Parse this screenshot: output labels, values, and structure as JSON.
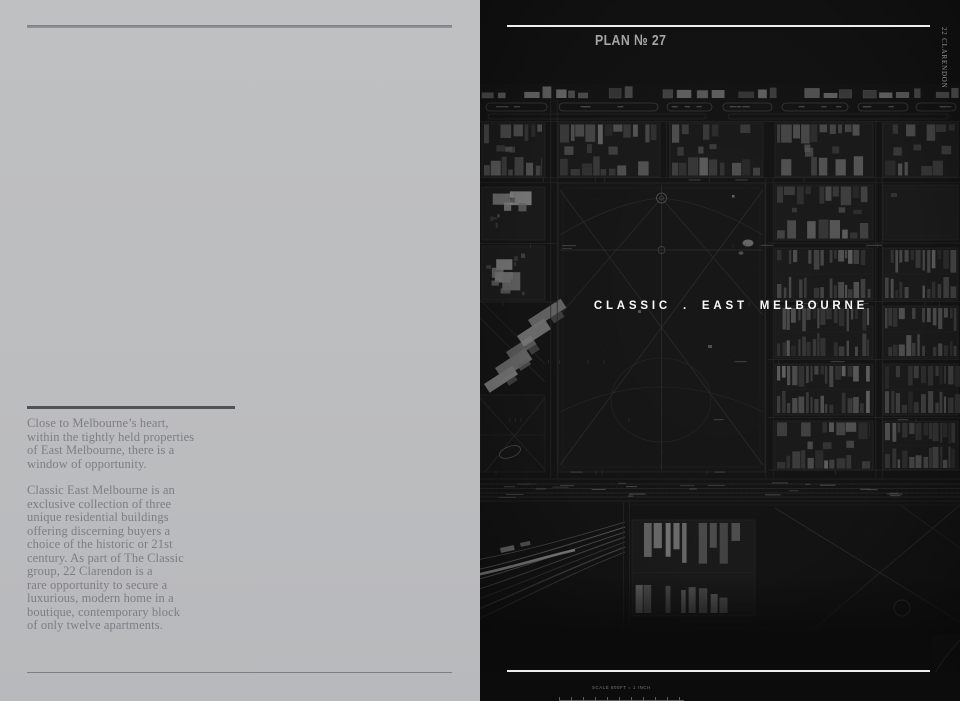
{
  "left_page": {
    "intro": "Close to Melbourne’s heart,\nwithin the tightly held properties\nof East Melbourne, there is a\nwindow of opportunity.",
    "body": "Classic East Melbourne is an\nexclusive collection of three\nunique residential buildings\noffering discerning buyers a\nchoice of the historic or 21st\ncentury. As part of The Classic\ngroup, 22 Clarendon is a\nrare opportunity to secure a\nluxurious, modern home in a\nboutique, contemporary block\nof only twelve apartments."
  },
  "right_page": {
    "plan_label": "PLAN № 27",
    "title": "CLASSIC . EAST MELBOURNE",
    "spine_label": "22 CLARENDON",
    "scale_label": "SCALE 800FT = 1 INCH"
  },
  "colors": {
    "left_background": "#bdbec0",
    "left_text": "#7d7d84",
    "left_rules": "#515157",
    "map_background": "#131313",
    "map_detail_gray": "#4a4a4a",
    "white_rules": "#eeeeee",
    "title_white": "#fafafa"
  }
}
